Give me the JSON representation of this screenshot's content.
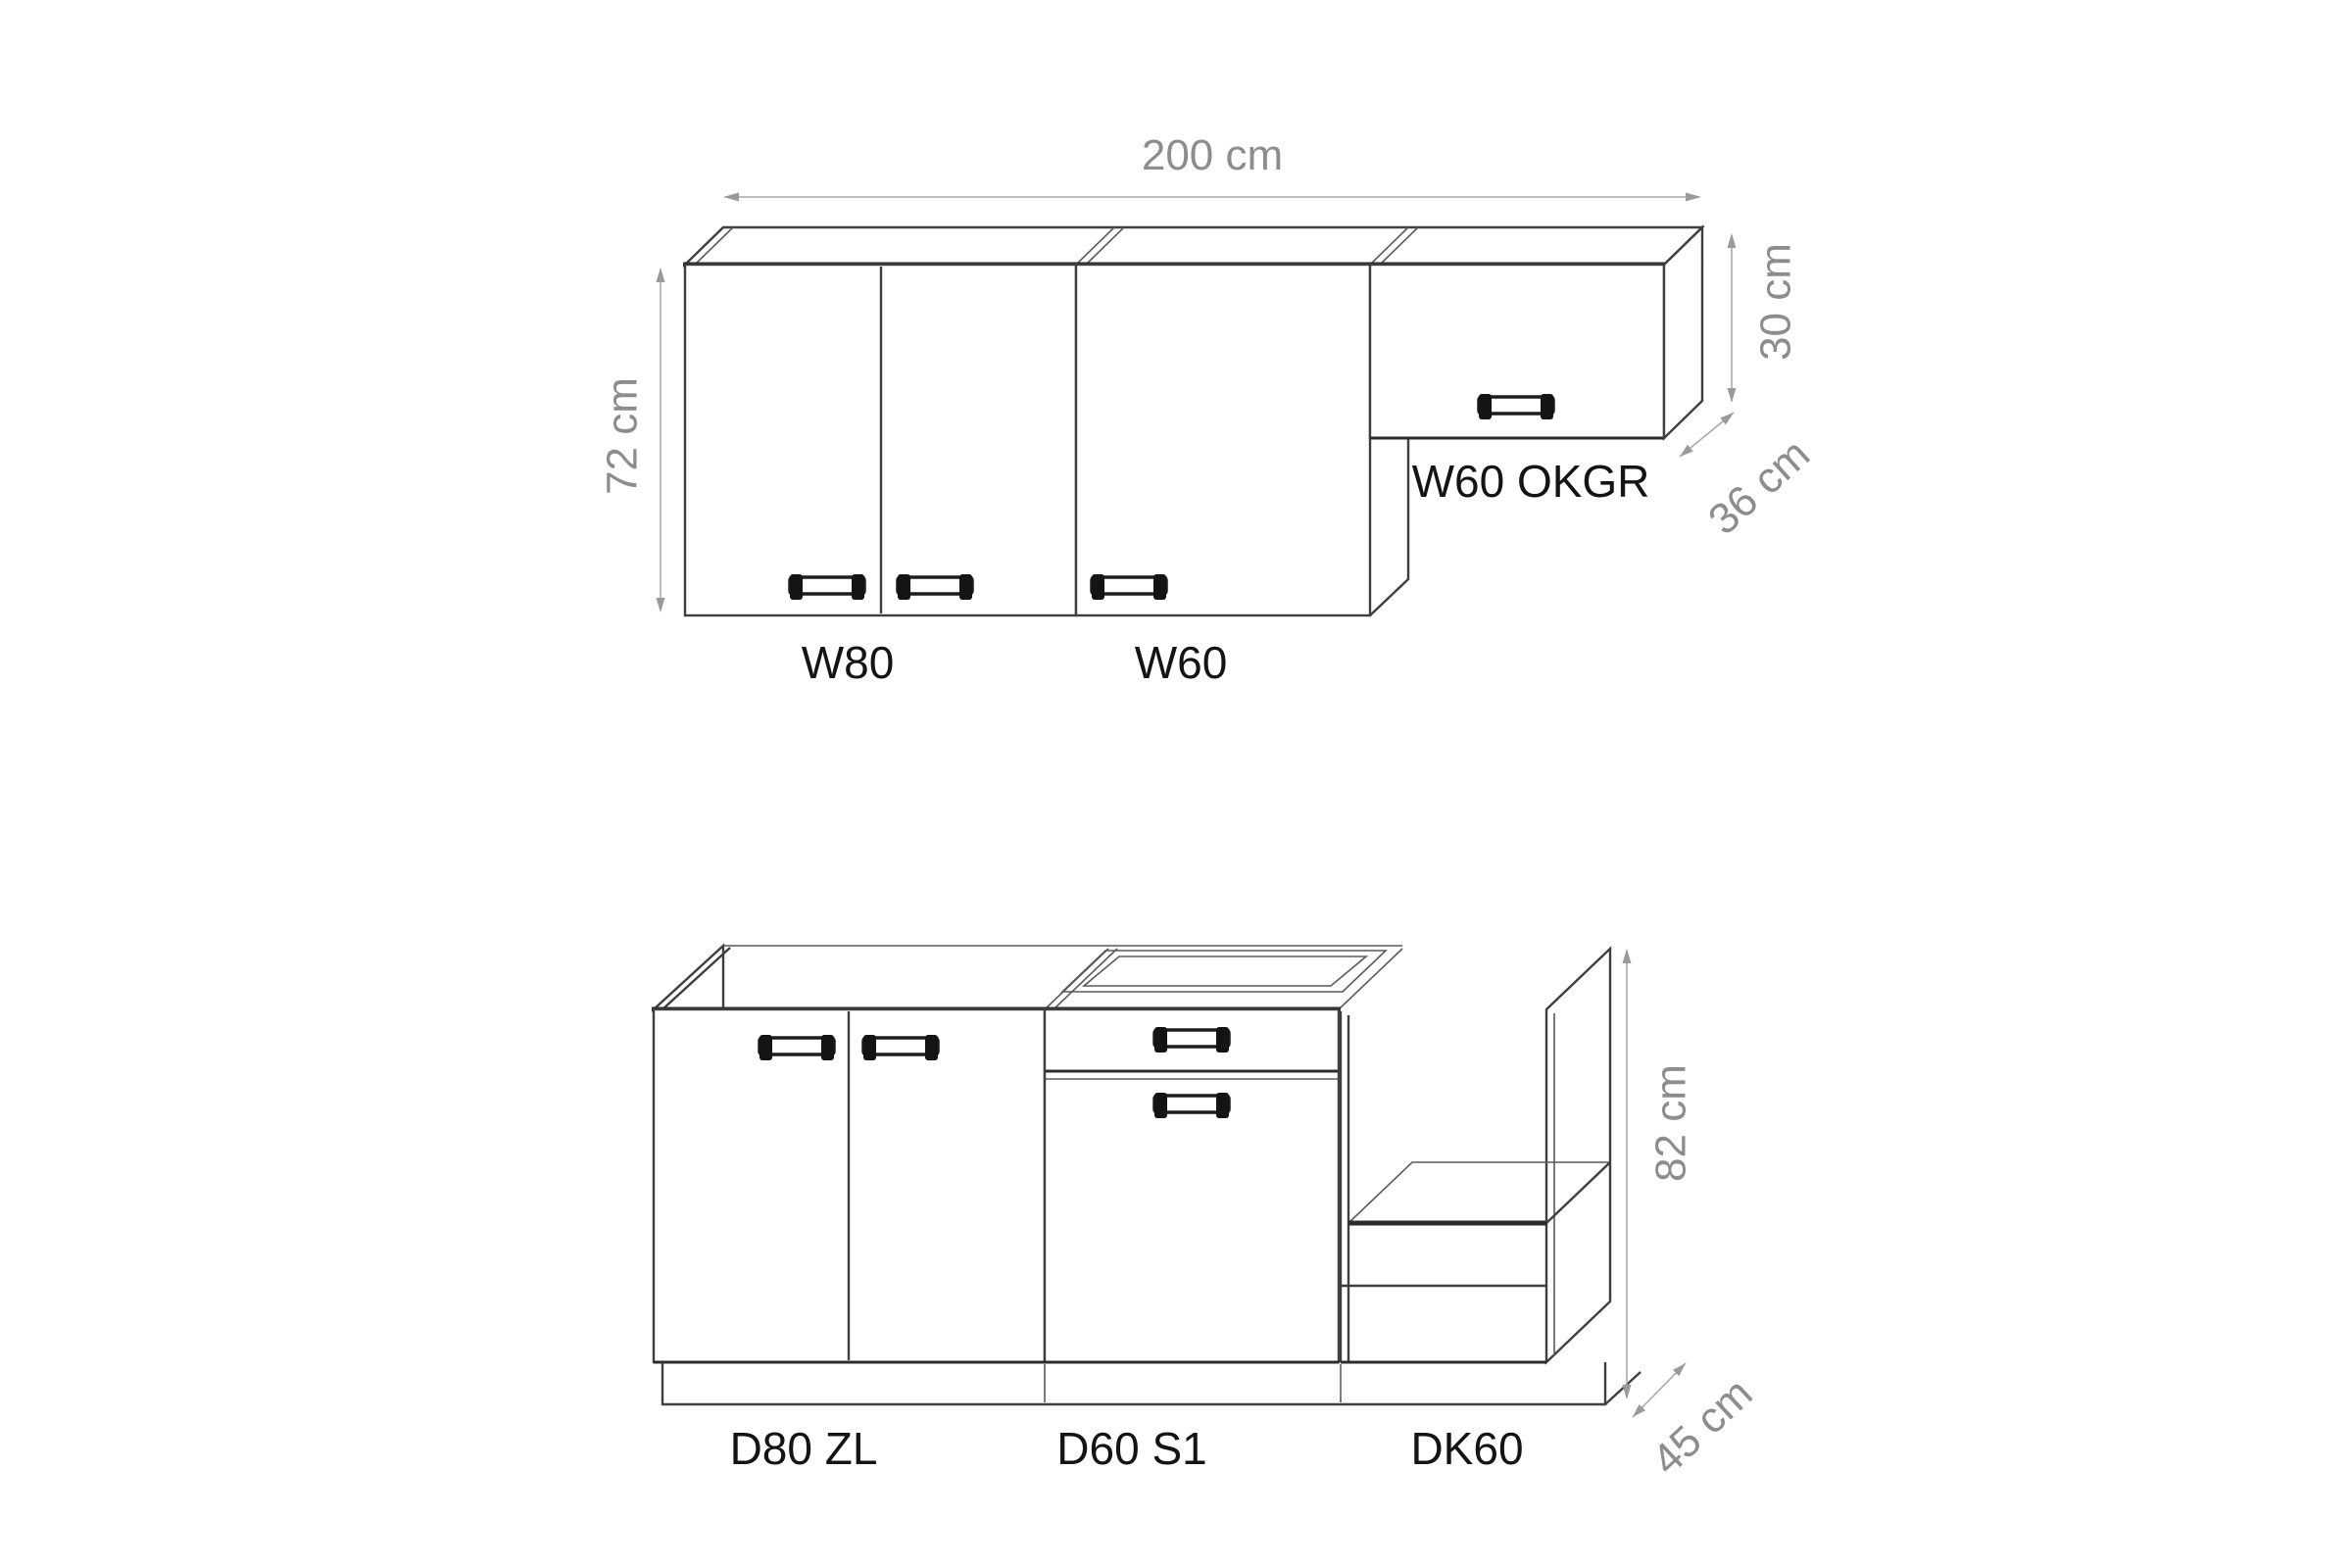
{
  "colors": {
    "background": "#ffffff",
    "line": "#3f3f3f",
    "heavy_line": "#2c2c2c",
    "dimension_line": "#a8a8a8",
    "dimension_text": "#8d8d8d",
    "label_text": "#141414",
    "handle": "#141414"
  },
  "wall_row": {
    "cabinets": [
      {
        "label": "W80"
      },
      {
        "label": "W60"
      },
      {
        "label": "W60 OKGR"
      }
    ],
    "dims": {
      "total_width": "200 cm",
      "height": "72 cm",
      "okgr_height": "30 cm",
      "depth": "36 cm"
    }
  },
  "base_row": {
    "cabinets": [
      {
        "label": "D80 ZL"
      },
      {
        "label": "D60 S1"
      },
      {
        "label": "DK60"
      }
    ],
    "dims": {
      "height": "82 cm",
      "depth": "45 cm"
    }
  }
}
